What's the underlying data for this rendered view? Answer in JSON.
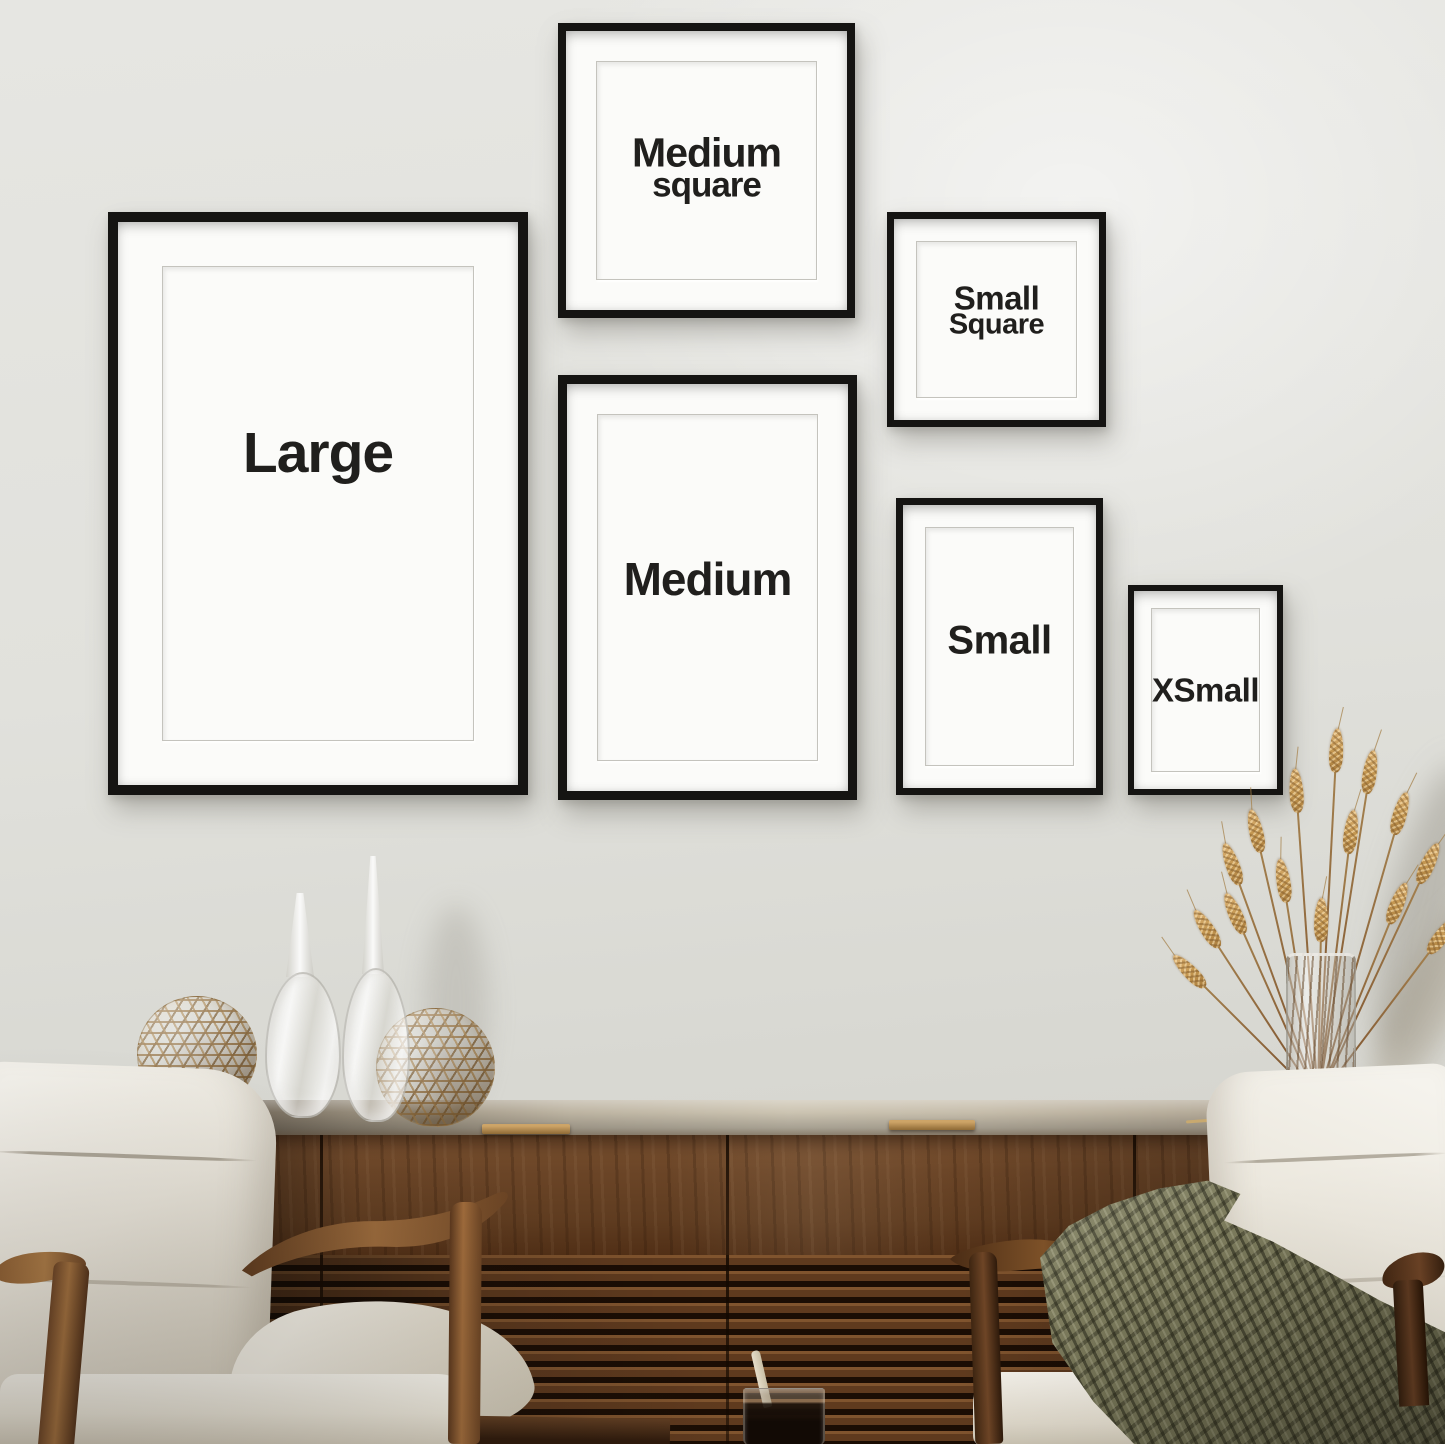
{
  "meta": {
    "title": "Frame size gallery wall mockup",
    "description": "Six black picture frames labeled Large, Medium square, Small Square, Medium, Small and XSmall hang on a pale wall above a walnut slatted sideboard styled with lattice spheres, glass vases and dried wheat, flanked by two ivory armchairs, one draped with an olive knit throw and a dark drink with a stir stick in the foreground."
  },
  "frames": [
    {
      "id": "large",
      "lines": [
        "Large"
      ]
    },
    {
      "id": "medium-square",
      "lines": [
        "Medium",
        "square"
      ]
    },
    {
      "id": "small-square",
      "lines": [
        "Small",
        "Square"
      ]
    },
    {
      "id": "medium",
      "lines": [
        "Medium"
      ]
    },
    {
      "id": "small",
      "lines": [
        "Small"
      ]
    },
    {
      "id": "xsmall",
      "lines": [
        "XSmall"
      ]
    }
  ],
  "colors": {
    "wall": "#e6e6e2",
    "frame_black": "#151412",
    "mat_white": "#fbfbf9",
    "label_text": "#201f1d",
    "wood": "#7a5130",
    "slat_gap": "#1b0d04",
    "brass": "#cda467",
    "chair_fabric": "#eae6dc",
    "chair_wood": "#a06c3c",
    "throw_olive": "#7e7d5e",
    "wheat_gold": "#dcb377",
    "wheat_dark": "#a87c3e",
    "glass_liquid": "#120a05"
  }
}
